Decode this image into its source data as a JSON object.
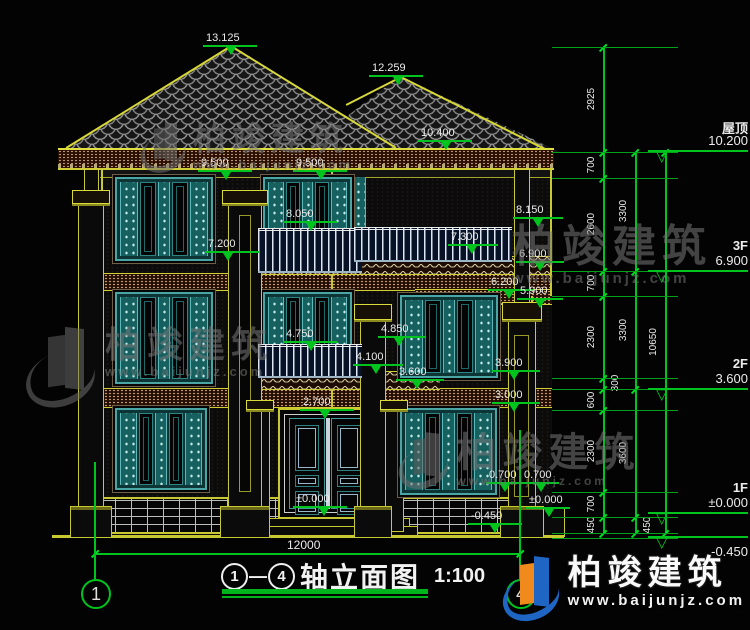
{
  "title": {
    "axis_start": "1",
    "separator": "—",
    "axis_end": "4",
    "text": "轴立面图",
    "scale": "1:100"
  },
  "bottom_dim": {
    "value": "12000"
  },
  "watermark": {
    "brand": "柏竣建筑",
    "url": "www.baijunjz.com"
  },
  "colors": {
    "dim_green": "#00c41e",
    "cad_yellow": "#c8c832",
    "teal": "#3d9a9a",
    "logo_blue": "#1f66c4",
    "logo_orange": "#f08a1d"
  },
  "axis_bubbles": [
    {
      "label": "1",
      "x": 95,
      "line_top": 462
    },
    {
      "label": "4",
      "x": 520,
      "line_top": 430
    }
  ],
  "level_markers": [
    {
      "name": "屋顶",
      "value": "10.200",
      "y": 150,
      "below": false
    },
    {
      "name": "3F",
      "value": "6.900",
      "y": 270,
      "below": false
    },
    {
      "name": "2F",
      "value": "3.600",
      "y": 388,
      "below": false
    },
    {
      "name": "1F",
      "value": "±0.000",
      "y": 512,
      "below": false
    },
    {
      "name": "",
      "value": "-0.450",
      "y": 536,
      "below": true
    }
  ],
  "elevation_markers": [
    {
      "value": "13.125",
      "x": 206,
      "y": 32,
      "tx": 231,
      "w": 54
    },
    {
      "value": "12.259",
      "x": 372,
      "y": 62,
      "tx": 398,
      "w": 54
    },
    {
      "value": "10.400",
      "x": 421,
      "y": 127,
      "tx": 446,
      "w": 54
    },
    {
      "value": "9.500",
      "x": 201,
      "y": 157,
      "tx": 226,
      "w": 54
    },
    {
      "value": "9.500",
      "x": 296,
      "y": 157,
      "tx": 321,
      "w": 54
    },
    {
      "value": "8.050",
      "x": 286,
      "y": 208,
      "tx": 311,
      "w": 54
    },
    {
      "value": "8.150",
      "x": 516,
      "y": 204,
      "tx": 538,
      "w": 50
    },
    {
      "value": "7.300",
      "x": 451,
      "y": 231,
      "tx": 472,
      "w": 50
    },
    {
      "value": "7.200",
      "x": 208,
      "y": 238,
      "tx": 228,
      "w": 54
    },
    {
      "value": "6.900",
      "x": 519,
      "y": 248,
      "tx": 540,
      "w": 48
    },
    {
      "value": "6.200",
      "x": 491,
      "y": 276,
      "tx": 509,
      "w": 46
    },
    {
      "value": "5.900",
      "x": 520,
      "y": 285,
      "tx": 540,
      "w": 46
    },
    {
      "value": "4.850",
      "x": 381,
      "y": 323,
      "tx": 399,
      "w": 48
    },
    {
      "value": "4.750",
      "x": 286,
      "y": 328,
      "tx": 311,
      "w": 54
    },
    {
      "value": "4.100",
      "x": 356,
      "y": 351,
      "tx": 376,
      "w": 50
    },
    {
      "value": "3.900",
      "x": 495,
      "y": 357,
      "tx": 514,
      "w": 48
    },
    {
      "value": "3.600",
      "x": 399,
      "y": 366,
      "tx": 417,
      "w": 48
    },
    {
      "value": "3.000",
      "x": 495,
      "y": 389,
      "tx": 514,
      "w": 48
    },
    {
      "value": "2.700",
      "x": 303,
      "y": 396,
      "tx": 325,
      "w": 54
    },
    {
      "value": "0.700",
      "x": 489,
      "y": 469,
      "tx": 505,
      "w": 38
    },
    {
      "value": "0.700",
      "x": 524,
      "y": 469,
      "tx": 541,
      "w": 38
    },
    {
      "value": "±0.000",
      "x": 296,
      "y": 493,
      "tx": 324,
      "w": 54
    },
    {
      "value": "±0.000",
      "x": 529,
      "y": 494,
      "tx": 549,
      "w": 44
    },
    {
      "value": "-0.450",
      "x": 471,
      "y": 510,
      "tx": 495,
      "w": 54
    }
  ],
  "dim_chains": [
    {
      "x": 603,
      "ticks": [
        47,
        152,
        178,
        271,
        296,
        378,
        389,
        410,
        492,
        517,
        533
      ],
      "labels": [
        {
          "t": "2925",
          "y": 99,
          "side": 0
        },
        {
          "t": "700",
          "y": 165,
          "side": 0
        },
        {
          "t": "2600",
          "y": 224,
          "side": 0
        },
        {
          "t": "700",
          "y": 283,
          "side": 0
        },
        {
          "t": "2300",
          "y": 337,
          "side": 0
        },
        {
          "t": "300",
          "y": 383,
          "side": 1
        },
        {
          "t": "600",
          "y": 400,
          "side": 0
        },
        {
          "t": "2300",
          "y": 451,
          "side": 0
        },
        {
          "t": "700",
          "y": 504,
          "side": 0
        },
        {
          "t": "450",
          "y": 525,
          "side": 0
        }
      ]
    },
    {
      "x": 635,
      "ticks": [
        152,
        271,
        389,
        517,
        533
      ],
      "labels": [
        {
          "t": "3300",
          "y": 211,
          "side": 0
        },
        {
          "t": "3300",
          "y": 330,
          "side": 0
        },
        {
          "t": "3600",
          "y": 453,
          "side": 0
        },
        {
          "t": "450",
          "y": 525,
          "side": 1
        }
      ]
    },
    {
      "x": 665,
      "ticks": [
        152,
        533
      ],
      "labels": [
        {
          "t": "10650",
          "y": 342,
          "side": 0
        }
      ]
    }
  ],
  "extension_lines_y": [
    47,
    152,
    178,
    271,
    296,
    378,
    389,
    410,
    492,
    517,
    533,
    538
  ],
  "watermarks_layout": [
    {
      "x": 140,
      "y": 122,
      "style": "grey",
      "logo": true,
      "logo_size": 50,
      "brand_size": 33,
      "url_size": 13
    },
    {
      "x": 25,
      "y": 326,
      "style": "grey",
      "logo": true,
      "logo_size": 80,
      "brand_size": 36,
      "url_size": 13
    },
    {
      "x": 512,
      "y": 224,
      "style": "grey",
      "logo": false,
      "logo_size": 0,
      "brand_size": 44,
      "url_size": 15
    },
    {
      "x": 398,
      "y": 432,
      "style": "grey",
      "logo": true,
      "logo_size": 56,
      "brand_size": 40,
      "url_size": 12
    },
    {
      "x": 502,
      "y": 556,
      "style": "color",
      "logo": true,
      "logo_size": 64,
      "brand_size": 34,
      "url_size": 15
    }
  ]
}
